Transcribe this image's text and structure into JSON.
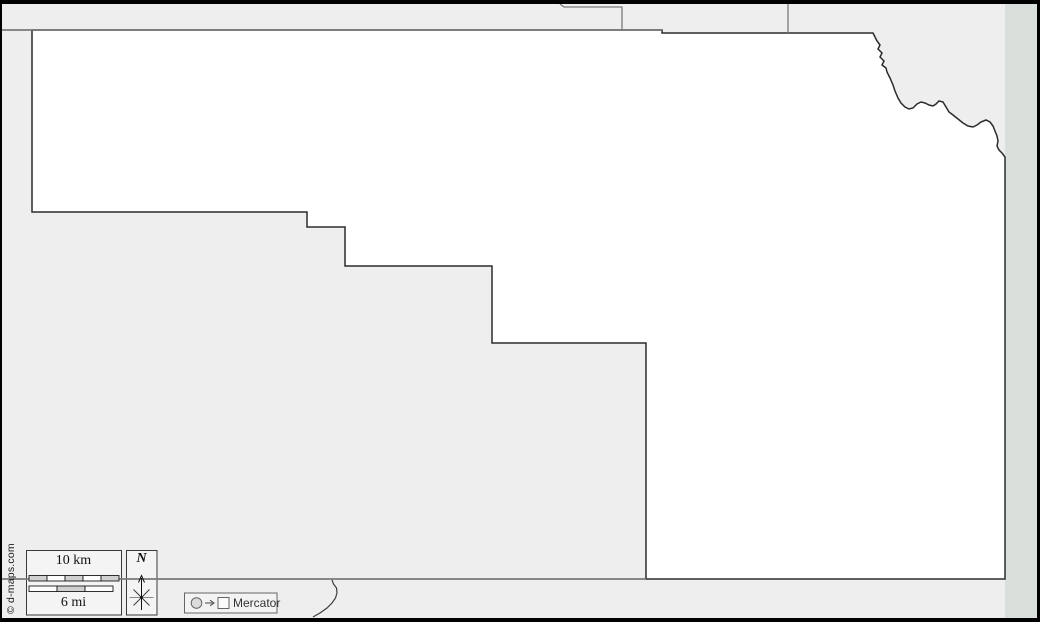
{
  "title": "Blank county outline map",
  "colors": {
    "background": "#eeeeee",
    "outside_band": "#d9e0dc",
    "county_fill": "#ffffff",
    "county_stroke": "#2b2b2b",
    "neighbor_stroke": "#7a7a7a",
    "river_stroke": "#3d3d3d",
    "frame": "#000000",
    "legend_box_fill": "#f4f4f4",
    "scale_segment_gray": "#d0d0d0",
    "scale_segment_white": "#fdfdfd"
  },
  "legend": {
    "scale": {
      "km_label": "10 km",
      "mi_label": "6 mi",
      "km_value": 10,
      "mi_value": 6
    },
    "compass": {
      "north_label": "N"
    },
    "projection": {
      "label": "Mercator"
    }
  },
  "credit": {
    "text": "© d-maps.com"
  },
  "map": {
    "projection": "Mercator",
    "outside_band_rect": [
      1005,
      0,
      32,
      622
    ],
    "county_outline": [
      [
        32,
        30
      ],
      [
        662,
        30
      ],
      [
        662,
        33
      ],
      [
        873,
        33
      ],
      [
        875,
        37
      ],
      [
        877,
        41
      ],
      [
        880,
        45
      ],
      [
        878,
        49
      ],
      [
        882,
        53
      ],
      [
        880,
        57
      ],
      [
        884,
        61
      ],
      [
        882,
        65
      ],
      [
        886,
        68
      ],
      [
        887,
        72
      ],
      [
        890,
        78
      ],
      [
        893,
        85
      ],
      [
        895,
        91
      ],
      [
        898,
        98
      ],
      [
        901,
        103
      ],
      [
        905,
        107
      ],
      [
        909,
        109
      ],
      [
        913,
        108
      ],
      [
        917,
        104
      ],
      [
        921,
        102
      ],
      [
        925,
        103
      ],
      [
        929,
        105
      ],
      [
        933,
        106
      ],
      [
        936,
        104
      ],
      [
        939,
        101
      ],
      [
        943,
        102
      ],
      [
        946,
        107
      ],
      [
        949,
        112
      ],
      [
        953,
        115
      ],
      [
        958,
        119
      ],
      [
        963,
        123
      ],
      [
        968,
        126
      ],
      [
        973,
        127
      ],
      [
        977,
        125
      ],
      [
        981,
        122
      ],
      [
        986,
        120
      ],
      [
        990,
        122
      ],
      [
        993,
        126
      ],
      [
        995,
        131
      ],
      [
        997,
        136
      ],
      [
        998,
        141
      ],
      [
        997,
        146
      ],
      [
        999,
        150
      ],
      [
        1002,
        153
      ],
      [
        1005,
        157
      ],
      [
        1005,
        579
      ],
      [
        646,
        579
      ],
      [
        646,
        343
      ],
      [
        492,
        343
      ],
      [
        492,
        266
      ],
      [
        345,
        266
      ],
      [
        345,
        227
      ],
      [
        307,
        227
      ],
      [
        307,
        212
      ],
      [
        32,
        212
      ]
    ],
    "gray_border_segments": [
      [
        [
          2,
          30
        ],
        [
          662,
          30
        ]
      ],
      [
        [
          2,
          579
        ],
        [
          646,
          579
        ]
      ]
    ],
    "neighbor_boundaries": [
      [
        [
          560,
          4
        ],
        [
          564,
          7
        ],
        [
          622,
          7
        ],
        [
          622,
          29
        ]
      ],
      [
        [
          788,
          4
        ],
        [
          788,
          33
        ]
      ]
    ],
    "river": [
      [
        332,
        580
      ],
      [
        333.5,
        584
      ],
      [
        336.5,
        588
      ],
      [
        337,
        593
      ],
      [
        335.5,
        598
      ],
      [
        332,
        603
      ],
      [
        327,
        608
      ],
      [
        320,
        613
      ],
      [
        313,
        617
      ]
    ]
  }
}
